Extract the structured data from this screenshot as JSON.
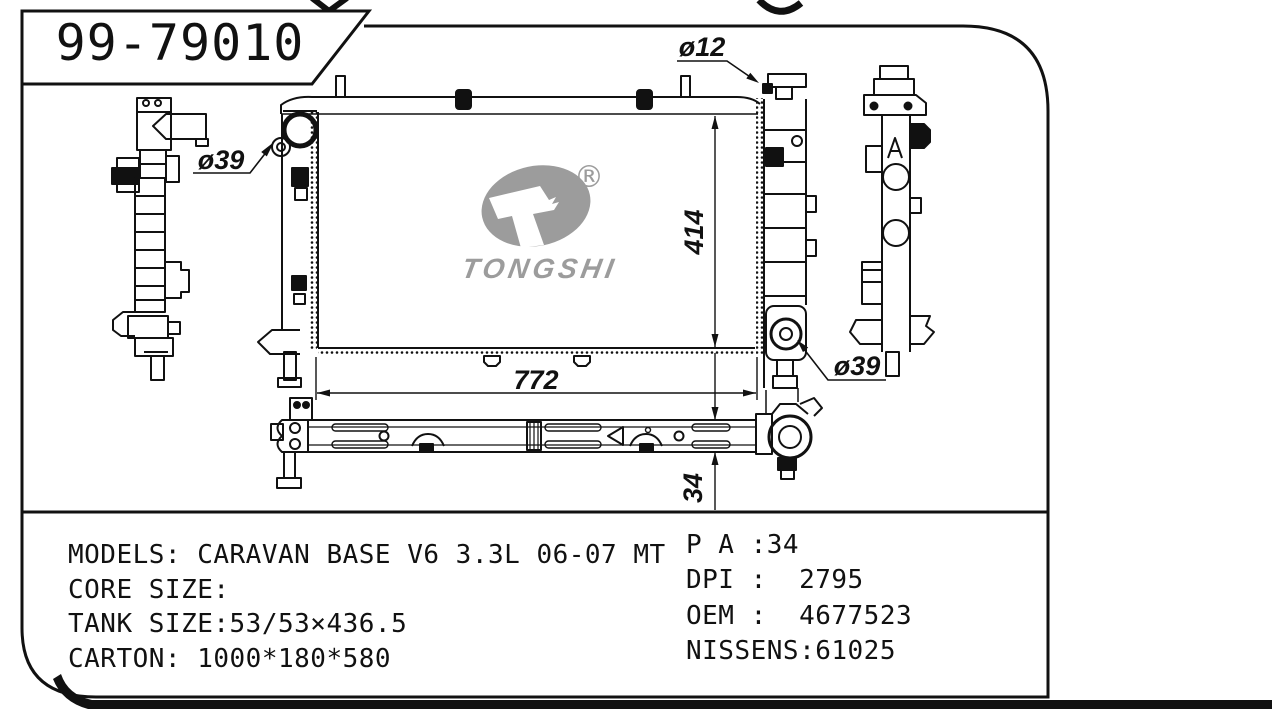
{
  "page": {
    "part_number": "99-79010"
  },
  "logo": {
    "name": "TONGSHI",
    "registered": "®",
    "color": "#9c9c9c"
  },
  "dimensions": {
    "core_width": "772",
    "core_height": "414",
    "crossmember_height": "34",
    "inlet_top_left": "ø39",
    "outlet_bottom_right": "ø39",
    "pipe_top_right": "ø12"
  },
  "specs": {
    "left": [
      "MODELS: CARAVAN BASE V6 3.3L 06-07 MT",
      "CORE SIZE:",
      "TANK SIZE:53/53×436.5",
      "CARTON: 1000*180*580"
    ],
    "right": [
      "P A :34",
      "DPI :  2795",
      "OEM :  4677523",
      "NISSENS:61025"
    ]
  },
  "colors": {
    "ink": "#111111",
    "logo_gray": "#9c9c9c",
    "paper": "#ffffff"
  }
}
